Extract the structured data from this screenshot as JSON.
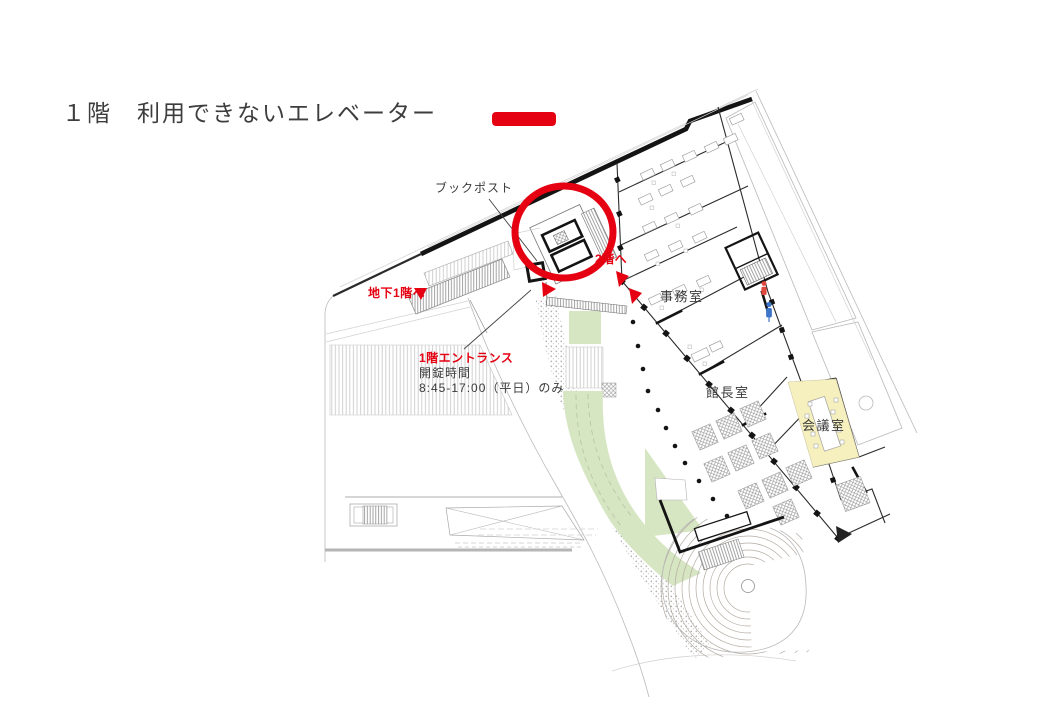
{
  "page": {
    "title": "１階　利用できないエレベーター"
  },
  "legend": {
    "marker_meaning": "unavailable-elevator-marker",
    "marker_color": "#e50012"
  },
  "floorplan": {
    "annotations": {
      "book_post": "ブックポスト",
      "to_2f": "2階へ",
      "to_b1f": "地下1階へ",
      "entrance_name": "1階エントランス",
      "entrance_unlock_label": "開錠時間",
      "entrance_hours": "8:45-17:00（平日）のみ"
    },
    "rooms": {
      "office": "事務室",
      "director": "館長室",
      "meeting": "会議室"
    },
    "colors": {
      "highlight": "#e50012",
      "meeting_room_fill": "#f5f0bd",
      "landscape_green": "#d7e6c2",
      "ink": "#2b2b2b"
    }
  }
}
